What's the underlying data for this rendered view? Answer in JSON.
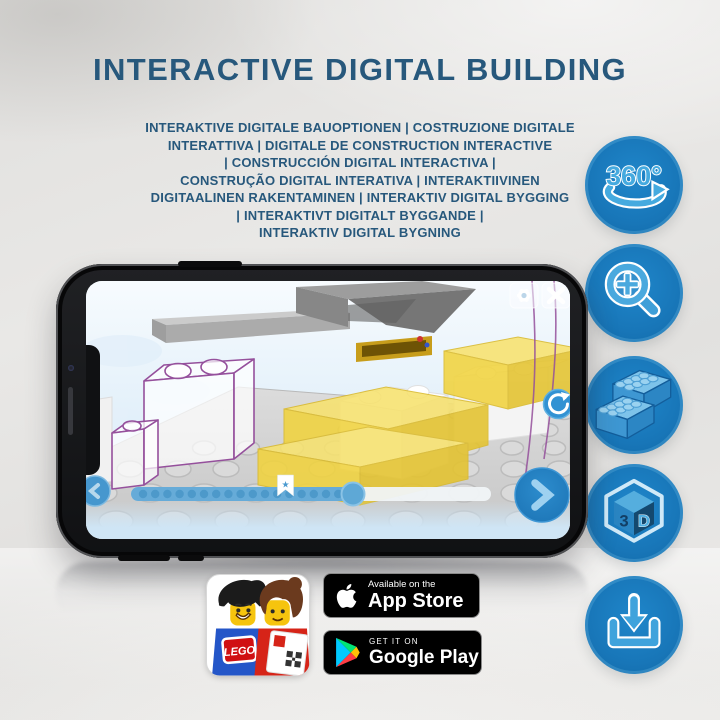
{
  "header": {
    "title": "INTERACTIVE DIGITAL BUILDING",
    "subtitle_lines": [
      "INTERAKTIVE DIGITALE BAUOPTIONEN | COSTRUZIONE DIGITALE",
      "INTERATTIVA | DIGITALE DE CONSTRUCTION INTERACTIVE",
      "| CONSTRUCCIÓN DIGITAL INTERACTIVA |",
      "CONSTRUÇÃO DIGITAL INTERATIVA | INTERAKTIIVINEN",
      "DIGITAALINEN RAKENTAMINEN | INTERAKTIV DIGITAL BYGGING",
      "| INTERAKTIVT DIGITALT BYGGANDE |",
      "INTERAKTIV DIGITAL BYGNING"
    ]
  },
  "feature_icons": {
    "items": [
      "360-rotation-icon",
      "zoom-in-icon",
      "bricks-icon",
      "3d-cube-icon",
      "download-icon"
    ],
    "rotate_label": "360°",
    "cube_digit": "3",
    "cube_letter": "D"
  },
  "phone_ui": {
    "buttons": [
      "settings",
      "close",
      "rotate-view",
      "next-step",
      "previous-step"
    ],
    "progress": {
      "dot_count": 17,
      "has_bookmark": true
    }
  },
  "app_icon": {
    "logo_text": "LEGO"
  },
  "badges": {
    "app_store": {
      "line1": "Available on the",
      "line2": "App Store"
    },
    "google_play": {
      "line1": "GET IT ON",
      "line2": "Google Play"
    }
  },
  "colors": {
    "title_blue": "#27587C",
    "circle_blue": "#1876B8",
    "icon_light_blue": "#45AADF",
    "app_button_blue": "#2381C5",
    "progress_blue": "#66ABD8",
    "brick_yellow": "#F1D33E",
    "ghost_outline_purple": "#95509C",
    "badge_black": "#000000"
  }
}
